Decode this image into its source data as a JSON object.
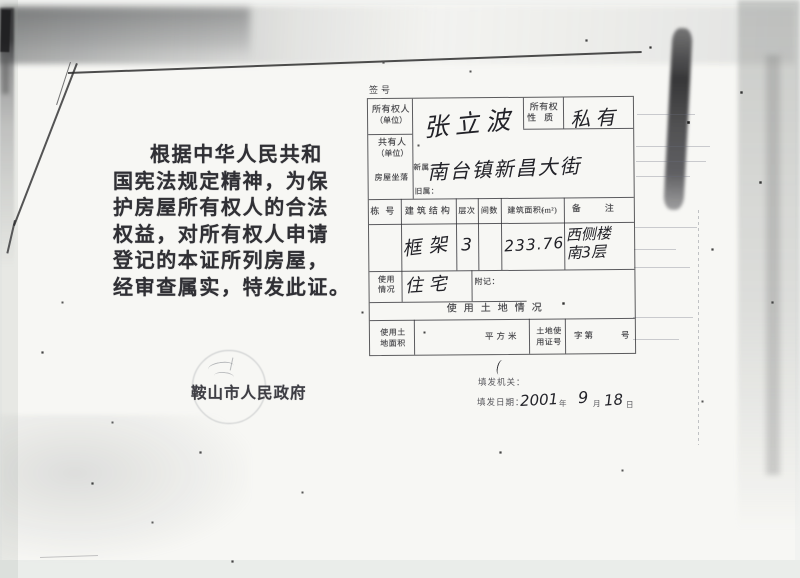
{
  "document": {
    "serial_label": "签号",
    "intro_lines": [
      "根据中华人民共和",
      "国宪法规定精神，为保",
      "护房屋所有权人的合法",
      "权益，对所有权人申请",
      "登记的本证所列房屋，",
      "经审查属实，特发此证。"
    ],
    "issuer": "鞍山市人民政府",
    "form": {
      "owner": {
        "label_line1": "所有权人",
        "label_line2": "（单位）",
        "value": "张立波"
      },
      "ownership_nature": {
        "label_line1": "所有权",
        "label_line2": "性质",
        "value": "私有"
      },
      "co_owner": {
        "label_line1": "共有人",
        "label_line2": "（单位）",
        "value": ""
      },
      "location": {
        "label": "房屋坐落",
        "new_label": "新属：",
        "new_value": "南台镇新昌大街",
        "old_label": "旧属：",
        "old_value": ""
      },
      "building": {
        "headers": [
          "栋号",
          "建筑结构",
          "层次",
          "间数",
          "建筑面积(m²)",
          "备注"
        ],
        "row": {
          "dong_no": "",
          "structure": "框架",
          "floors": "3",
          "rooms": "",
          "area": "233.76",
          "remark_line1": "西侧楼",
          "remark_line2": "南3层"
        }
      },
      "usage": {
        "label_line1": "使用",
        "label_line2": "情况",
        "value": "住宅"
      },
      "annex_label": "附记：",
      "land": {
        "section_title": "使用土地情况",
        "area_label_line1": "使用土",
        "area_label_line2": "地面积",
        "area_unit": "平方米",
        "cert_label_line1": "土地使",
        "cert_label_line2": "用证号",
        "cert_prefix": "字第",
        "cert_suffix": "号"
      }
    },
    "footer": {
      "org_label": "填发机关：",
      "date_label": "填发日期：",
      "year": "2001",
      "year_unit": "年",
      "month": "9",
      "month_unit": "月",
      "day": "18",
      "day_unit": "日"
    }
  },
  "colors": {
    "paper": "#f7f7f4",
    "print_ink": "#46464a",
    "handwriting_ink": "#222228",
    "table_line": "#303034",
    "scan_noise": "#8f9598"
  }
}
